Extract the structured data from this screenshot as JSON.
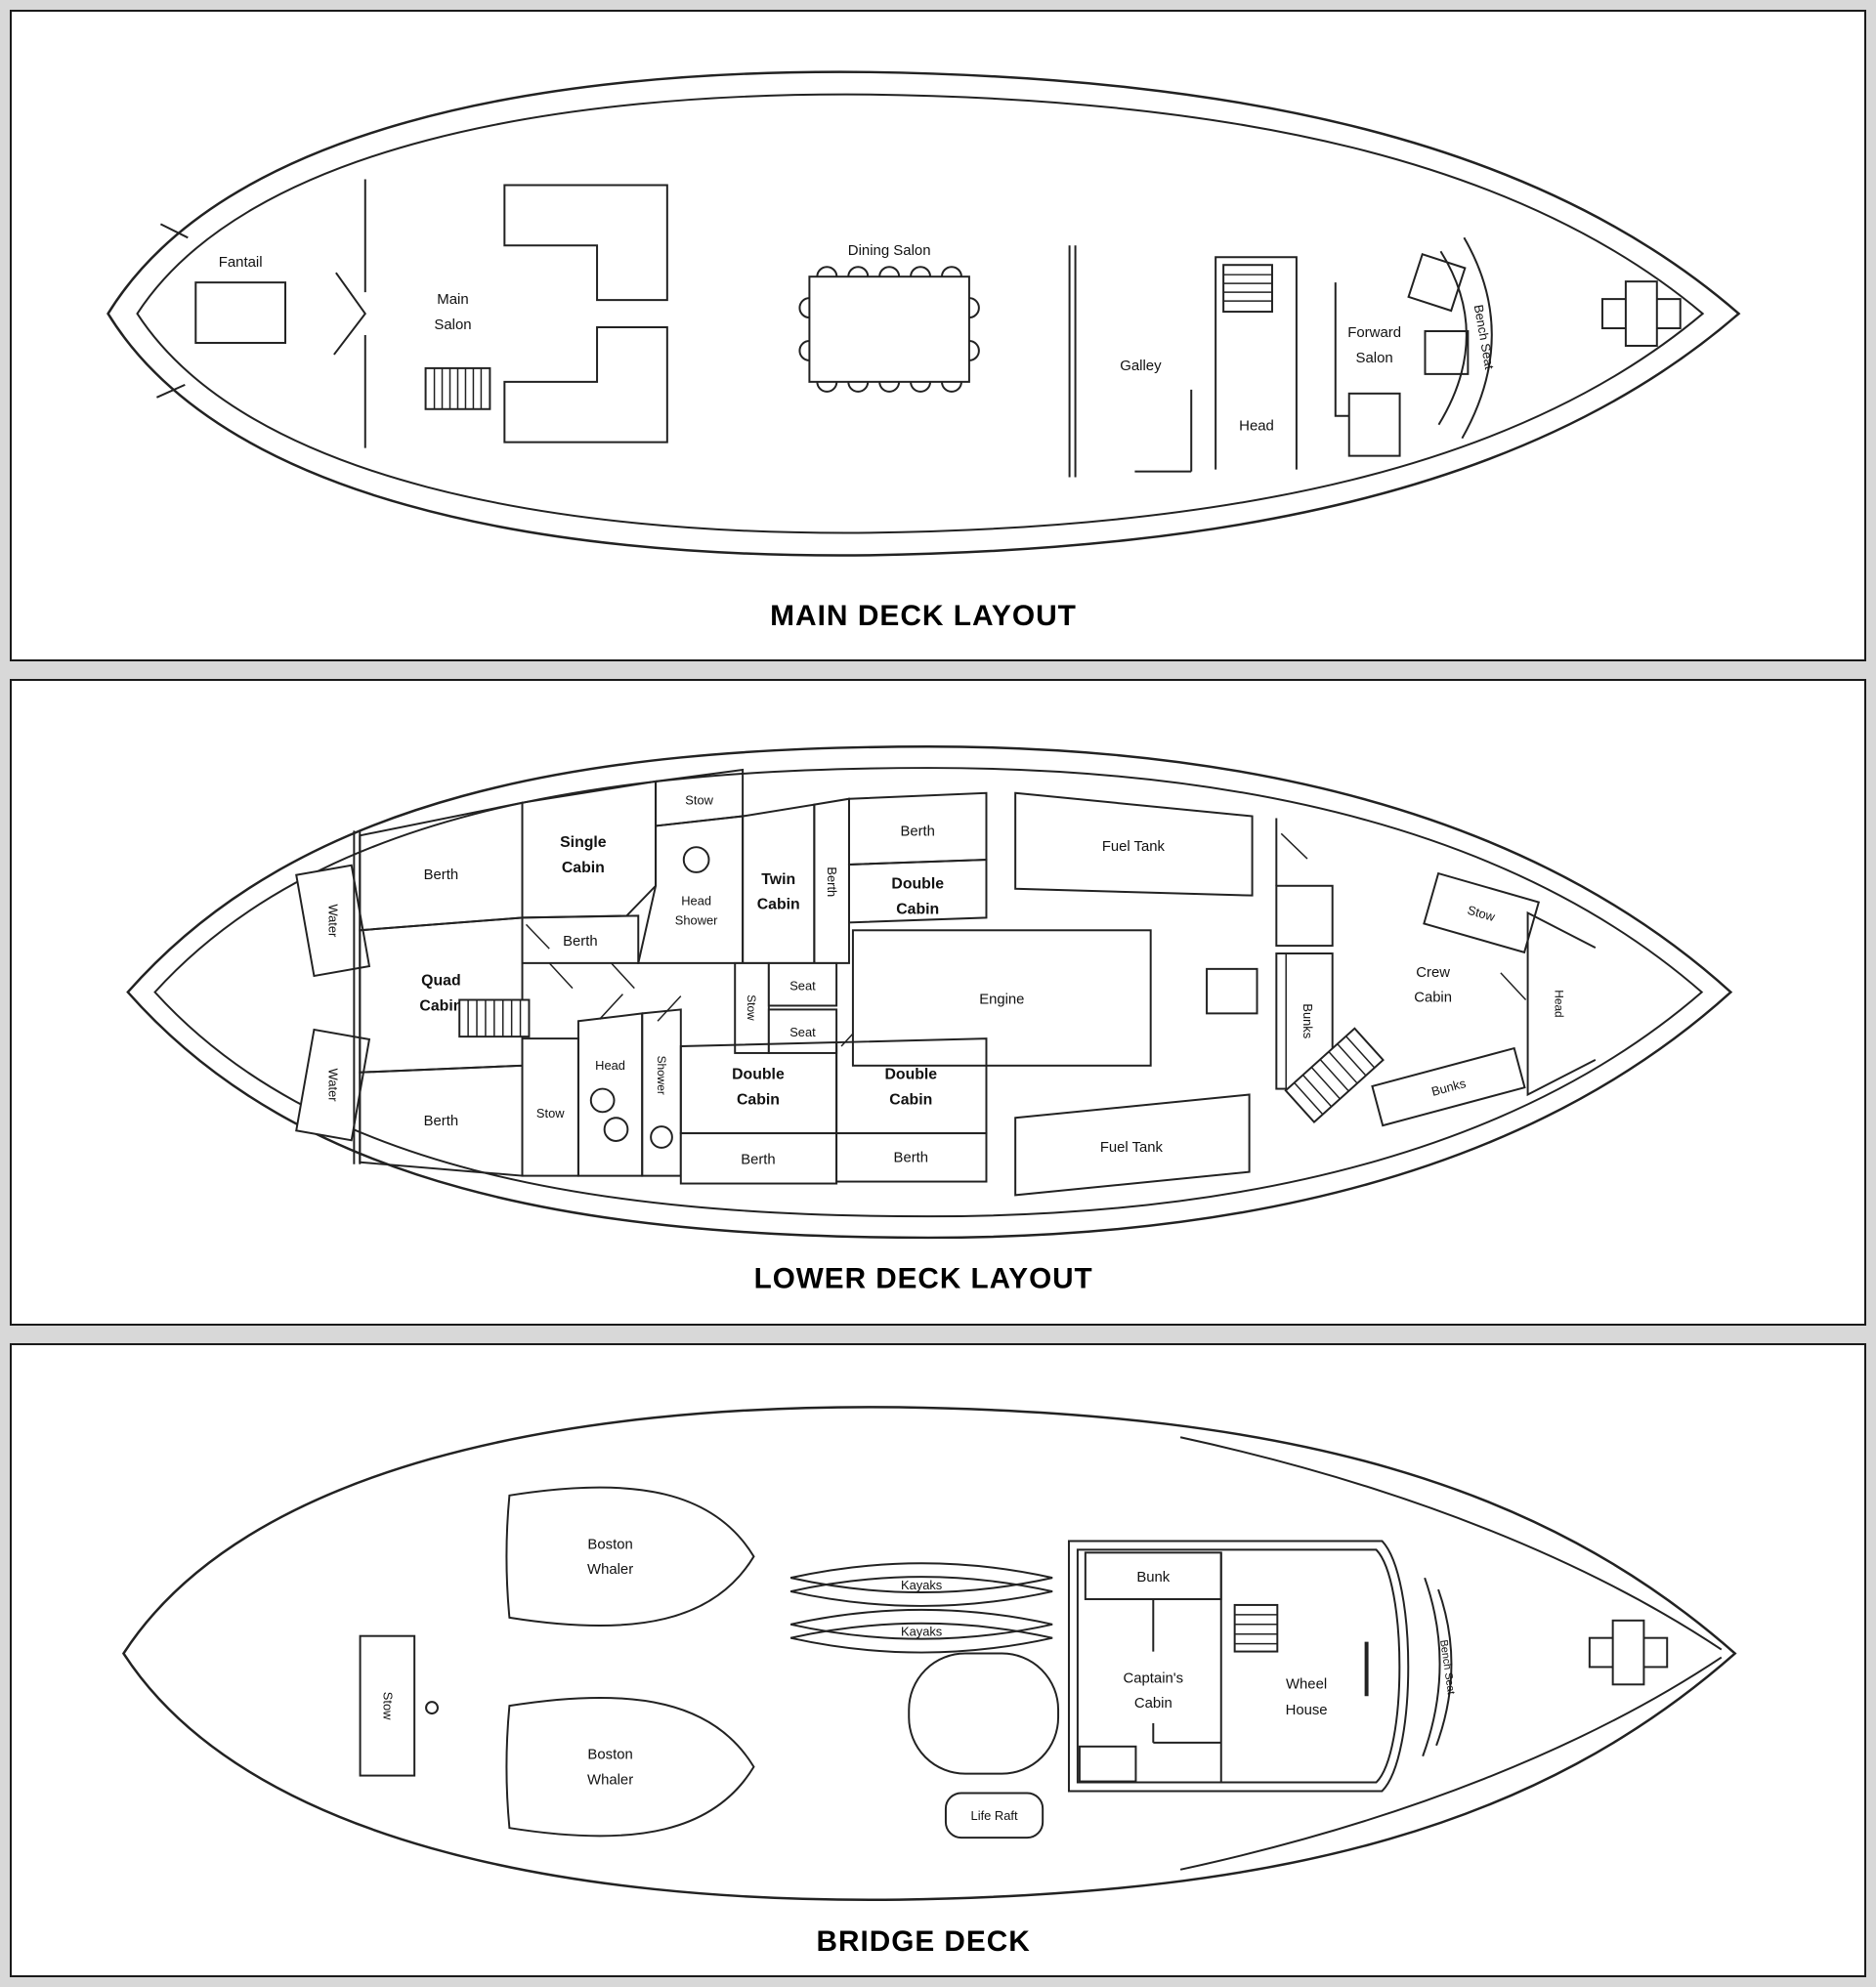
{
  "colors": {
    "line": "#222222",
    "panel_bg": "#ffffff",
    "page_bg": "#d8d8d8",
    "text": "#111111"
  },
  "main_deck": {
    "title": "MAIN DECK LAYOUT",
    "fantail": "Fantail",
    "main_salon": [
      "Main",
      "Salon"
    ],
    "dining_salon": "Dining Salon",
    "galley": "Galley",
    "head": "Head",
    "forward_salon": [
      "Forward",
      "Salon"
    ],
    "bench_seat": "Bench Seat"
  },
  "lower_deck": {
    "title": "LOWER DECK LAYOUT",
    "water_top": "Water",
    "water_bottom": "Water",
    "berth_top_aft": "Berth",
    "quad_cabin": [
      "Quad",
      "Cabin"
    ],
    "berth_bottom_aft": "Berth",
    "single_cabin": [
      "Single",
      "Cabin"
    ],
    "berth_below_single": "Berth",
    "stow_top": "Stow",
    "head_shower": [
      "Head",
      "Shower"
    ],
    "twin_cabin": [
      "Twin",
      "Cabin"
    ],
    "berth_vertical": "Berth",
    "berth_above_double": "Berth",
    "double_cabin_upper": [
      "Double",
      "Cabin"
    ],
    "fuel_tank_upper": "Fuel Tank",
    "stow_center": "Stow",
    "seat_upper": "Seat",
    "seat_lower": "Seat",
    "engine": "Engine",
    "stow_bottom": "Stow",
    "head_bottom": "Head",
    "shower_bottom": "Shower",
    "double_cabin_lower_aft": [
      "Double",
      "Cabin"
    ],
    "berth_below_lower_aft": "Berth",
    "double_cabin_lower_fwd": [
      "Double",
      "Cabin"
    ],
    "berth_below_lower_fwd": "Berth",
    "fuel_tank_lower": "Fuel Tank",
    "bunks_side": "Bunks",
    "crew_cabin": [
      "Crew",
      "Cabin"
    ],
    "stow_crew": "Stow",
    "head_crew": "Head",
    "bunks_crew": "Bunks"
  },
  "bridge_deck": {
    "title": "BRIDGE DECK",
    "boston_whaler_top": [
      "Boston",
      "Whaler"
    ],
    "boston_whaler_bottom": [
      "Boston",
      "Whaler"
    ],
    "stow": "Stow",
    "kayaks_upper": "Kayaks",
    "kayaks_lower": "Kayaks",
    "life_raft": "Life Raft",
    "bunk": "Bunk",
    "captains_cabin": [
      "Captain's",
      "Cabin"
    ],
    "wheel_house": [
      "Wheel",
      "House"
    ],
    "bench_seat": "Bench Seat"
  }
}
